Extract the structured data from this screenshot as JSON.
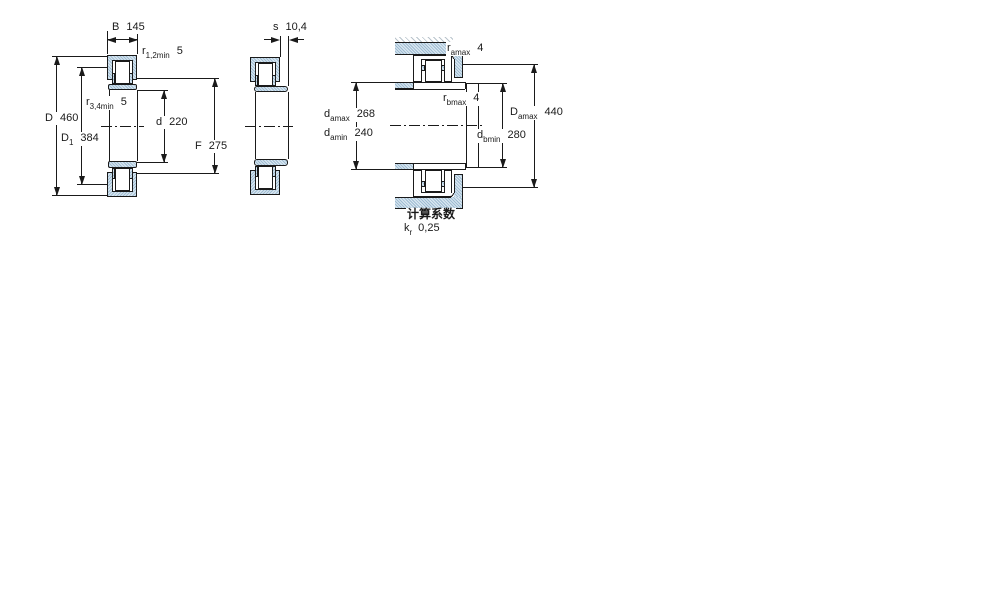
{
  "figures": {
    "fig1": {
      "dim_B": {
        "name": "B",
        "value": "145"
      },
      "dim_r12": {
        "name": "r",
        "sub": "1,2min",
        "value": "5"
      },
      "dim_r34": {
        "name": "r",
        "sub": "3,4min",
        "value": "5"
      },
      "dim_D": {
        "name": "D",
        "value": "460"
      },
      "dim_D1": {
        "name": "D",
        "sub": "1",
        "value": "384"
      },
      "dim_d": {
        "name": "d",
        "value": "220"
      },
      "dim_F": {
        "name": "F",
        "value": "275"
      }
    },
    "fig2": {
      "dim_s": {
        "name": "s",
        "value": "10,4"
      }
    },
    "fig3": {
      "dim_ramax": {
        "name": "r",
        "sub": "amax",
        "value": "4"
      },
      "dim_rbmax": {
        "name": "r",
        "sub": "bmax",
        "value": "4"
      },
      "dim_damax": {
        "name": "d",
        "sub": "amax",
        "value": "268"
      },
      "dim_damin": {
        "name": "d",
        "sub": "amin",
        "value": "240"
      },
      "dim_Damax": {
        "name": "D",
        "sub": "amax",
        "value": "440"
      },
      "dim_dbmin": {
        "name": "d",
        "sub": "bmin",
        "value": "280"
      }
    },
    "calc": {
      "heading": "计算系数",
      "kr": {
        "name": "k",
        "sub": "r",
        "value": "0,25"
      }
    }
  },
  "colors": {
    "line": "#1a1a1a",
    "ring_fill_dark": "#9fbcd2",
    "ring_fill_light": "#d9e7f1"
  }
}
